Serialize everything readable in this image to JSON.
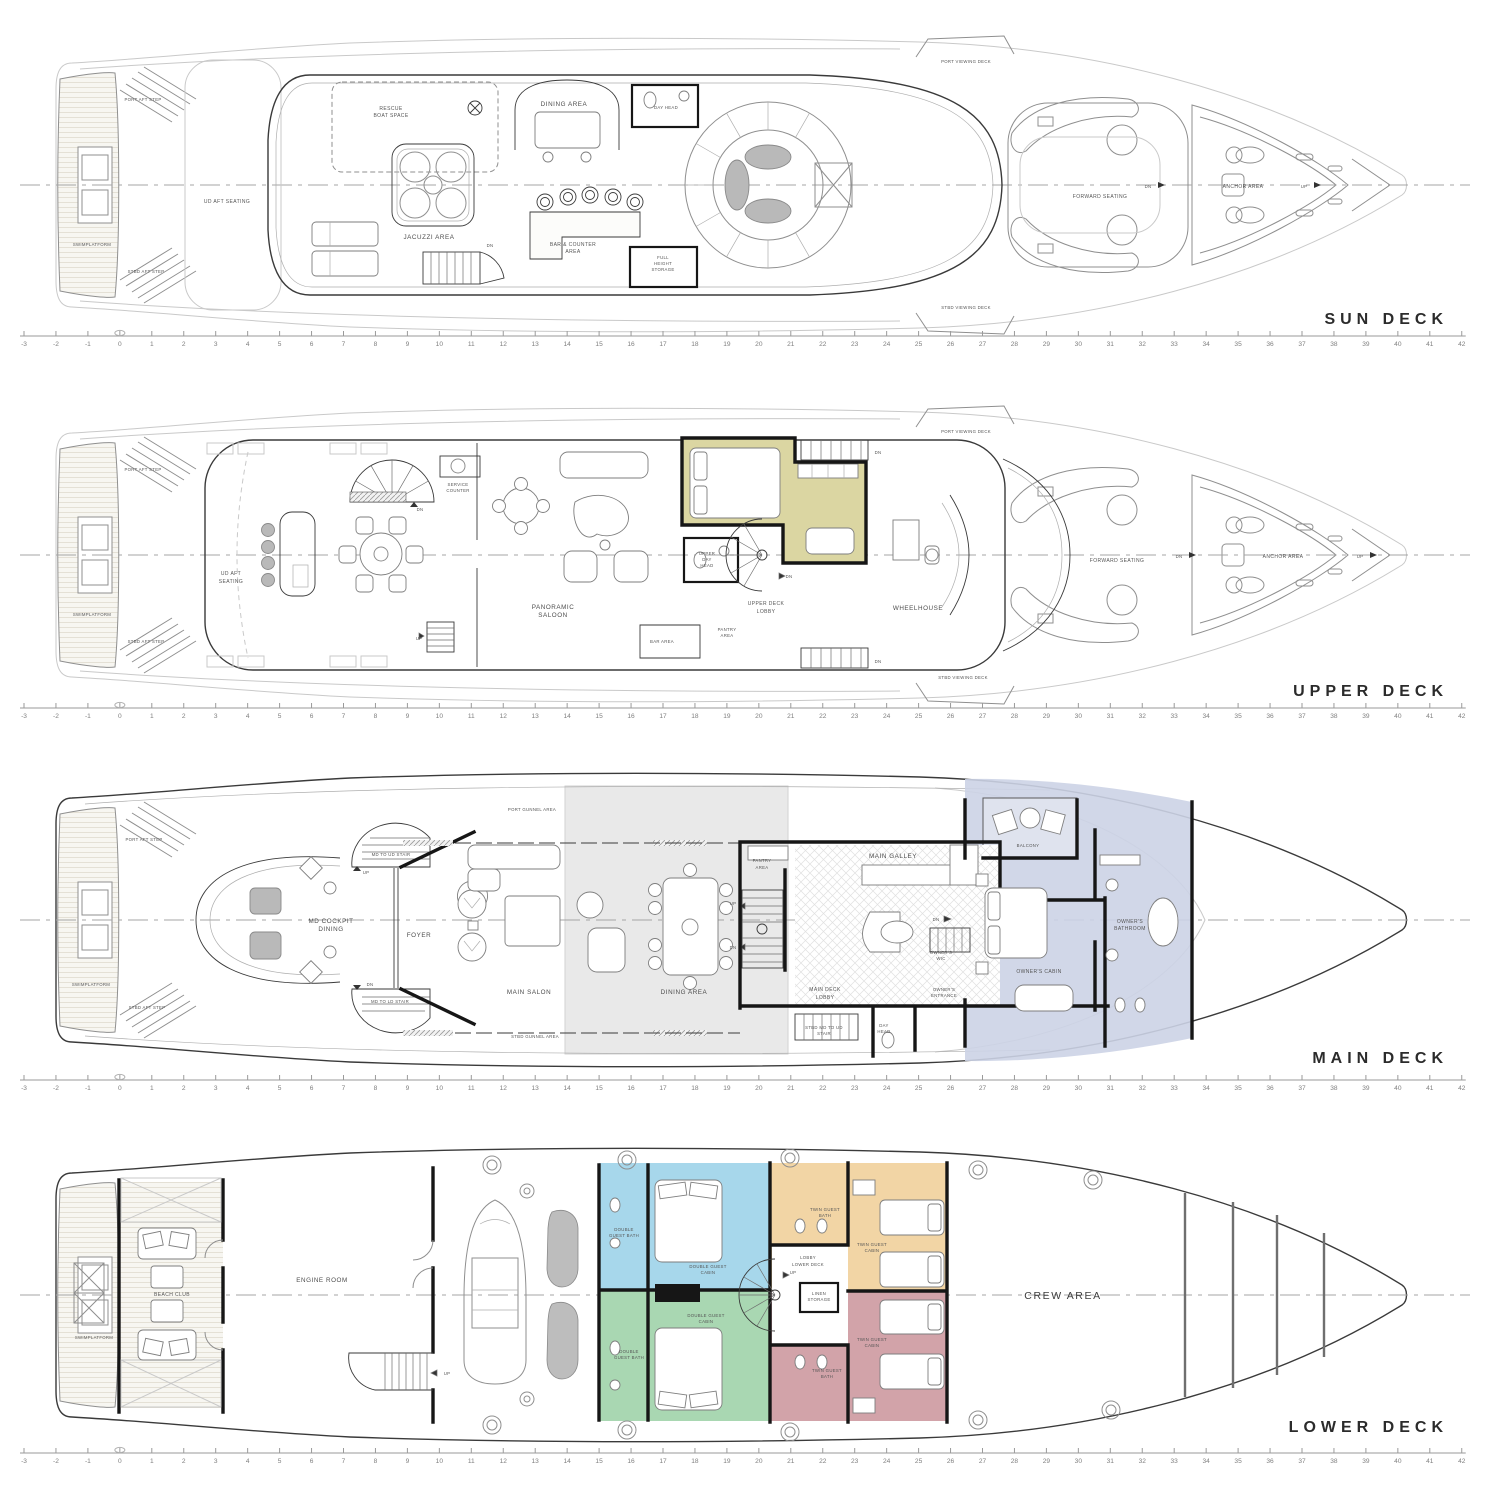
{
  "document": {
    "type": "yacht general arrangement plan",
    "background": "#ffffff"
  },
  "colors": {
    "line_dark": "#3a3a3a",
    "line_mid": "#8f8f8f",
    "line_light": "#c9c9c9",
    "wall": "#161616",
    "label": "#4d4d4d",
    "furniture_gray": "#b9b9b9",
    "ghost_fill": "#e6e6e6",
    "captain_cabin": "#dbd6a2",
    "owner_suite": "#ccd3e5",
    "owner_balcony": "#dfe3ee",
    "guest_double_blue": "#a7d7eb",
    "guest_double_green": "#a9d7b2",
    "guest_twin_tan": "#f2d5a5",
    "guest_twin_red": "#d2a3a9"
  },
  "ruler": {
    "min": -3,
    "max": 42,
    "origin_x": 24,
    "step_px": 31.95,
    "deck_y": [
      336,
      708,
      1080,
      1453
    ]
  },
  "decks": {
    "sun": {
      "title": "SUN DECK",
      "rooms": {
        "port_aft_step": "PORT AFT STEP",
        "swimplatform": "SWIMPLATFORM",
        "stbd_aft_step": "STBD AFT STEP",
        "ud_aft_seating": "UD AFT SEATING",
        "rescue_boat_space_1": "RESCUE",
        "rescue_boat_space_2": "BOAT SPACE",
        "jacuzzi_area": "JACUZZI AREA",
        "dining_area": "DINING AREA",
        "day_head": "DAY HEAD",
        "bar_counter_1": "BAR & COUNTER",
        "bar_counter_2": "AREA",
        "full_height_1": "FULL",
        "full_height_2": "HEIGHT",
        "full_height_3": "STORAGE",
        "port_viewing_deck": "PORT VIEWING DECK",
        "stbd_viewing_deck": "STBD VIEWING DECK",
        "forward_seating": "FORWARD SEATING",
        "anchor_area": "ANCHOR AREA"
      },
      "nav": {
        "dn": "DN",
        "up": "UP"
      }
    },
    "upper": {
      "title": "UPPER DECK",
      "rooms": {
        "port_aft_step": "PORT AFT STEP",
        "swimplatform": "SWIMPLATFORM",
        "stbd_aft_step": "STBD AFT STEP",
        "ud_aft_seating_1": "UD AFT",
        "ud_aft_seating_2": "SEATING",
        "service_counter_1": "SERVICE",
        "service_counter_2": "COUNTER",
        "panoramic_saloon_1": "PANORAMIC",
        "panoramic_saloon_2": "SALOON",
        "bar_area": "BAR AREA",
        "pantry_area_1": "PANTRY",
        "pantry_area_2": "AREA",
        "upper_day_head_1": "UPPER",
        "upper_day_head_2": "DAY",
        "upper_day_head_3": "HEAD",
        "upper_deck_lobby_1": "UPPER DECK",
        "upper_deck_lobby_2": "LOBBY",
        "wheelhouse": "WHEELHOUSE",
        "port_viewing_deck": "PORT VIEWING DECK",
        "stbd_viewing_deck": "STBD VIEWING DECK",
        "forward_seating": "FORWARD SEATING",
        "anchor_area": "ANCHOR AREA"
      },
      "nav": {
        "dn": "DN",
        "up": "UP"
      }
    },
    "main": {
      "title": "MAIN DECK",
      "rooms": {
        "port_aft_step": "PORT AFT STEP",
        "swimplatform": "SWIMPLATFORM",
        "stbd_aft_step": "STBD AFT STEP",
        "port_gunnel_area": "PORT GUNNEL AREA",
        "stbd_gunnel_area": "STBD GUNNEL AREA",
        "md_cockpit_dining_1": "MD COCKPIT",
        "md_cockpit_dining_2": "DINING",
        "md_to_ud_stair": "MD TO UD STAIR",
        "md_to_ld_stair": "MD TO LD STAIR",
        "foyer": "FOYER",
        "main_salon": "MAIN SALON",
        "dining_area": "DINING AREA",
        "pantry_area_1": "PANTRY",
        "pantry_area_2": "AREA",
        "main_galley": "MAIN GALLEY",
        "main_deck_lobby_1": "MAIN DECK",
        "main_deck_lobby_2": "LOBBY",
        "stbd_md_to_ud_stair_1": "STBD MD TO UD",
        "stbd_md_to_ud_stair_2": "STAIR",
        "day_head_1": "DAY",
        "day_head_2": "HEAD",
        "owners_wic_1": "OWNER'S",
        "owners_wic_2": "WIC",
        "owners_entrance_1": "OWNER'S",
        "owners_entrance_2": "ENTRANCE",
        "owners_cabin": "OWNER'S CABIN",
        "owners_bathroom_1": "OWNER'S",
        "owners_bathroom_2": "BATHROOM",
        "balcony": "BALCONY"
      },
      "nav": {
        "dn": "DN",
        "up": "UP"
      }
    },
    "lower": {
      "title": "LOWER DECK",
      "rooms": {
        "swimplatform": "SWIMPLATFORM",
        "beach_club": "BEACH CLUB",
        "engine_room": "ENGINE ROOM",
        "double_guest_bath_1": "DOUBLE",
        "double_guest_bath_2": "GUEST BATH",
        "double_guest_cabin_1": "DOUBLE GUEST",
        "double_guest_cabin_2": "CABIN",
        "twin_guest_bath_1": "TWIN GUEST",
        "twin_guest_bath_2": "BATH",
        "twin_guest_cabin_1": "TWIN GUEST",
        "twin_guest_cabin_2": "CABIN",
        "lobby_lower_deck_1": "LOBBY",
        "lobby_lower_deck_2": "LOWER DECK",
        "linen_storage_1": "LINEN",
        "linen_storage_2": "STORAGE",
        "crew_area": "CREW AREA"
      },
      "nav": {
        "up": "UP"
      }
    }
  }
}
